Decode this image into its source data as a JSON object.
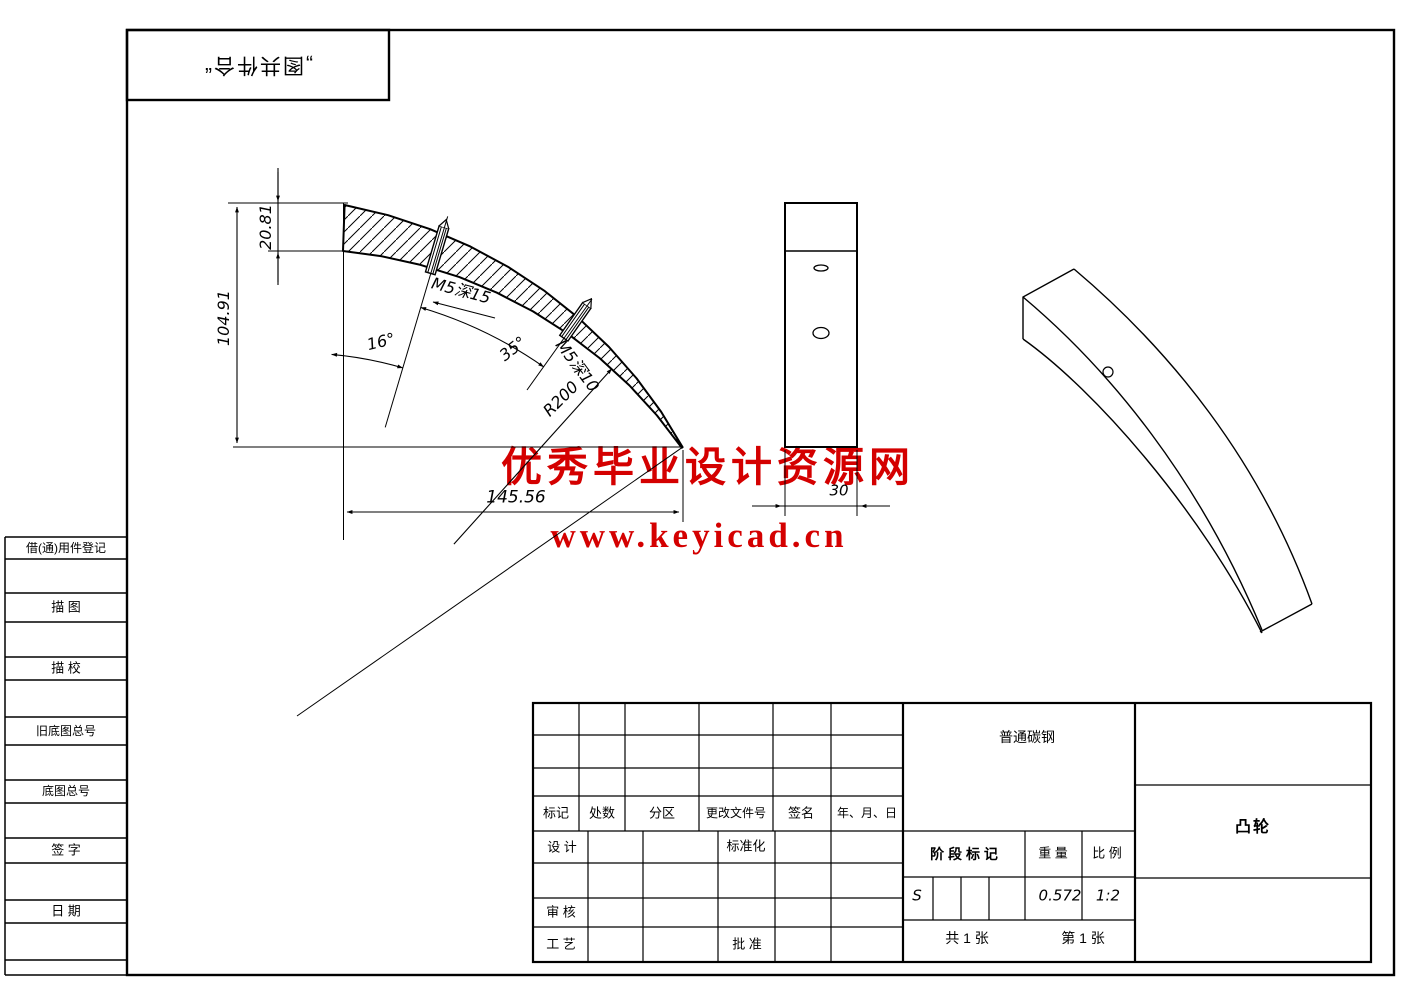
{
  "stamp": {
    "text": "„图共件合“"
  },
  "watermark": {
    "line1": "优秀毕业设计资源网",
    "line2": "www.keyicad.cn",
    "color": "#d40000"
  },
  "left_strip": {
    "labels": [
      "借(通)用件登记",
      "描 图",
      "描 校",
      "旧底图总号",
      "底图总号",
      "签 字",
      "日 期"
    ]
  },
  "dimensions": {
    "height_top": "20.81",
    "height_total": "104.91",
    "width": "145.56",
    "radius": "R200",
    "angle_1": "16°",
    "angle_2": "35°",
    "hole_1": "M5深15",
    "hole_2": "M5深10",
    "thickness": "30"
  },
  "title_block": {
    "revision_columns": [
      "标记",
      "处数",
      "分区",
      "更改文件号",
      "签名",
      "年、月、日"
    ],
    "design": "设 计",
    "standardization": "标准化",
    "audit": "审 核",
    "process": "工 艺",
    "approve": "批 准",
    "material": "普通碳钢",
    "stage_label": "阶 段 标 记",
    "weight_label": "重 量",
    "scale_label": "比 例",
    "stage_value": "S",
    "weight_value": "0.572",
    "scale_value": "1:2",
    "sheets_total": "共 1 张",
    "sheet_number": "第 1 张",
    "part_name": "凸轮"
  }
}
